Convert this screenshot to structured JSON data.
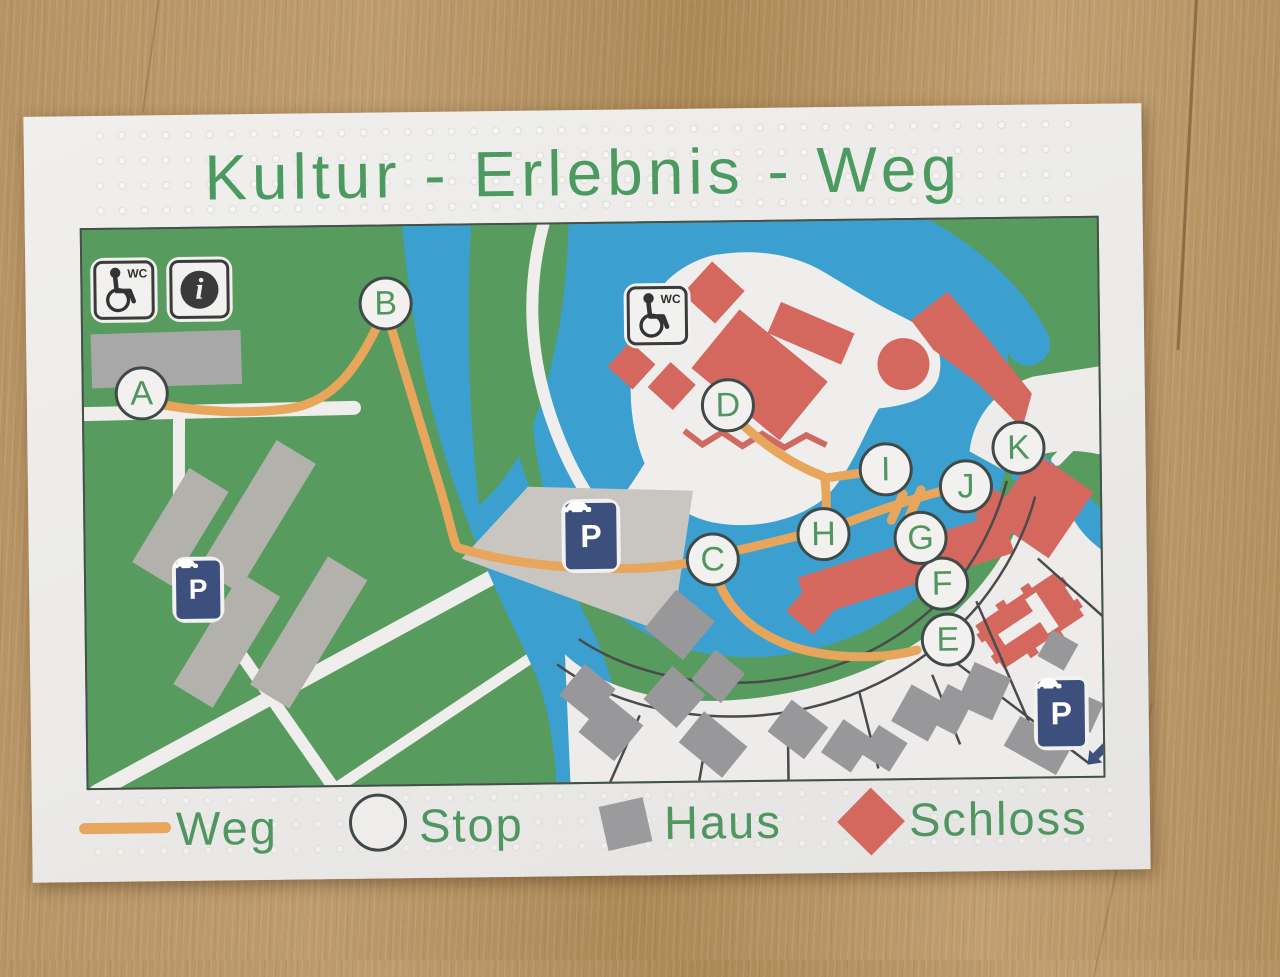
{
  "title": "Kultur - Erlebnis - Weg",
  "map": {
    "stops": [
      {
        "label": "A"
      },
      {
        "label": "B"
      },
      {
        "label": "C"
      },
      {
        "label": "D"
      },
      {
        "label": "E"
      },
      {
        "label": "F"
      },
      {
        "label": "G"
      },
      {
        "label": "H"
      },
      {
        "label": "I"
      },
      {
        "label": "J"
      },
      {
        "label": "K"
      }
    ],
    "signs": {
      "wc_label": "WC",
      "parking_label": "P",
      "info_glyph": "i"
    }
  },
  "legend": {
    "items": [
      {
        "label": "Weg",
        "symbol": "path-line",
        "color": "#e8a55c"
      },
      {
        "label": "Stop",
        "symbol": "circle-outline",
        "color": "#eeedeb"
      },
      {
        "label": "Haus",
        "symbol": "gray-square",
        "color": "#9b9b9d"
      },
      {
        "label": "Schloss",
        "symbol": "red-diamond",
        "color": "#d4685f"
      }
    ]
  },
  "colors": {
    "title_green": "#4b9a60",
    "path_orange": "#e8a55c",
    "water_blue": "#3ba0d0",
    "park_green": "#579b5f",
    "castle_red": "#d4685f",
    "house_gray": "#98989a",
    "sign_blue": "#3d4f7c",
    "wood": "#b08d58"
  }
}
